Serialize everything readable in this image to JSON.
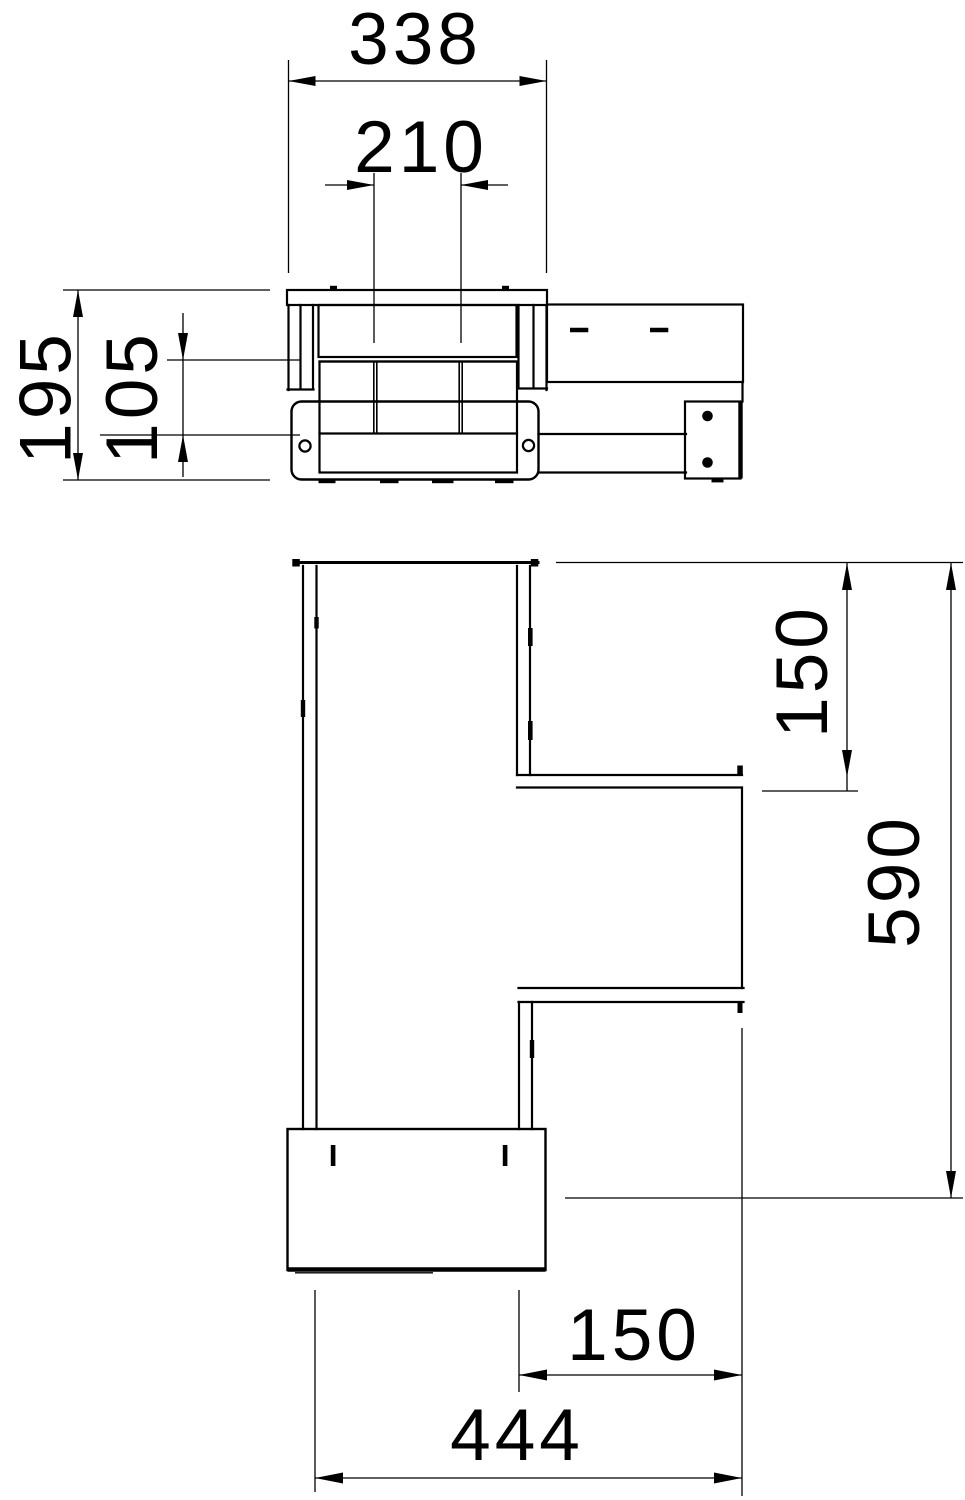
{
  "drawing": {
    "type": "technical-dimension-drawing",
    "background_color": "#ffffff",
    "line_color": "#000000",
    "views": {
      "front": {
        "label": "front-elevation",
        "dims": {
          "overall_width": "338",
          "inner_width": "210",
          "overall_height": "195",
          "body_height": "105"
        }
      },
      "plan": {
        "label": "plan-view",
        "dims": {
          "branch_depth": "150",
          "overall_length": "590",
          "branch_width": "150",
          "overall_width": "444"
        }
      }
    }
  }
}
